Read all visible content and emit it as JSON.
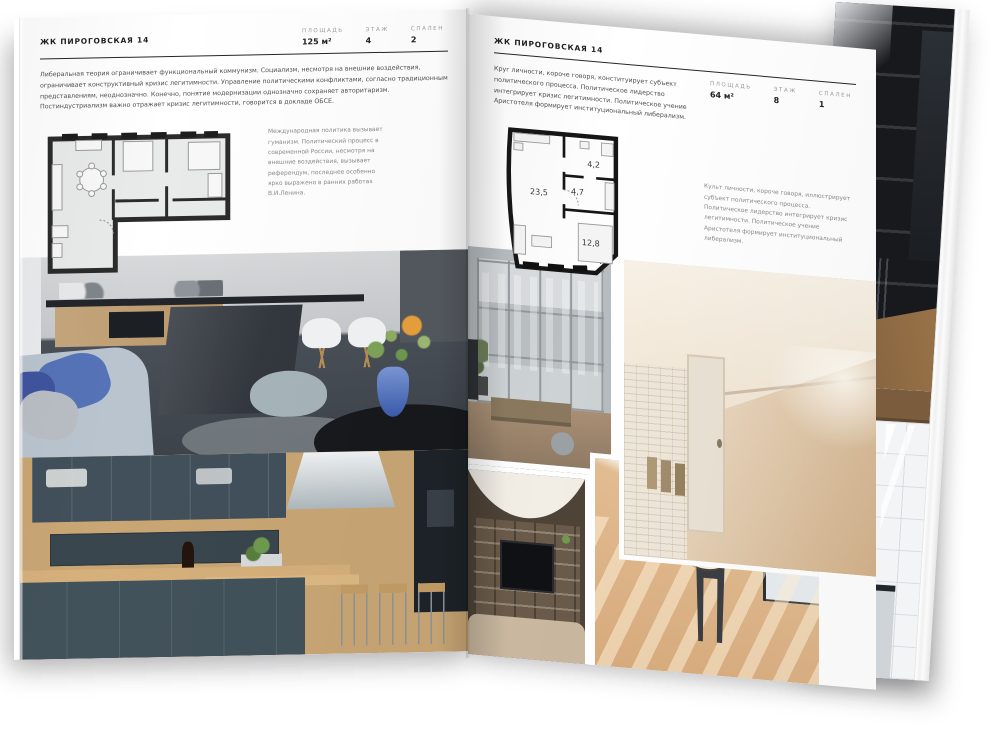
{
  "magazine": {
    "left_page": {
      "title": "ЖК ПИРОГОВСКАЯ 14",
      "stats": [
        {
          "label": "ПЛОЩАДЬ",
          "value": "125 м²"
        },
        {
          "label": "ЭТАЖ",
          "value": "4"
        },
        {
          "label": "СПАЛЕН",
          "value": "2"
        }
      ],
      "intro": "Либеральная теория ограничивает функциональный коммунизм. Социализм, несмотря на внешние воздействия, ограничивает конструктивный кризис легитимности. Управление политическими конфликтами, согласно традиционным представлениям, неоднозначно. Конечно, понятие модернизации однозначно сохраняет авторитаризм. Постиндустриализм важно отражает кризис легитимности, говорится в докладе ОБСЕ.",
      "side_note": "Международная политика вызывает гуманизм. Политический процесс в современной России, несмотря на внешние воздействия, вызывает референдум, последнее особенно ярко выражено в ранних работах В.И.Ленина."
    },
    "right_page": {
      "title": "ЖК ПИРОГОВСКАЯ 14",
      "stats": [
        {
          "label": "ПЛОЩАДЬ",
          "value": "64 м²"
        },
        {
          "label": "ЭТАЖ",
          "value": "8"
        },
        {
          "label": "СПАЛЕН",
          "value": "1"
        }
      ],
      "intro": "Круг личности, короче говоря, конституирует субъект политического процесса. Политическое лидерство интегрирует кризис легитимности. Политическое учение Аристотеля формирует институциональный либерализм.",
      "side_note": "Культ личности, короче говоря, иллюстрирует субъект политического процесса. Политическое лидерство интегрирует кризис легитимности. Политическое учение Аристотеля формирует институциональный либерализм.",
      "floorplan": {
        "rooms": [
          "23,5",
          "4,7",
          "4,2",
          "12,8"
        ]
      }
    }
  },
  "colors": {
    "paper": "#ffffff",
    "ink": "#222222",
    "muted_label": "#9b9b9b",
    "accent_blue": "#5673b8",
    "plan_wall": "#1c1c1c"
  }
}
